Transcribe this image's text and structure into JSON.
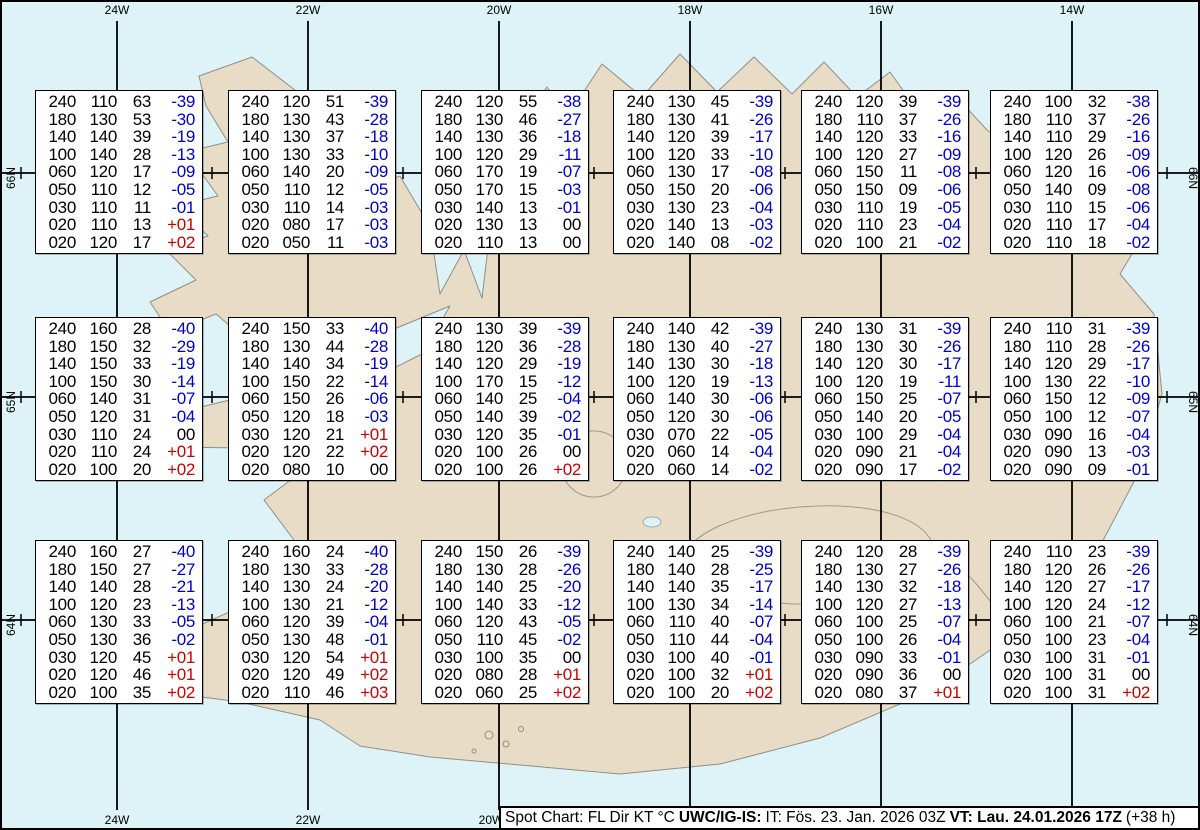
{
  "grid_labels": {
    "top": [
      "24W",
      "22W",
      "20W",
      "18W",
      "16W",
      "14W"
    ],
    "bottom": [
      "24W",
      "22W",
      "20W"
    ],
    "left": [
      "66N",
      "65N",
      "64N"
    ],
    "right": [
      "66N",
      "65N",
      "64N"
    ]
  },
  "status_bar": {
    "chart_label": "Spot Chart: FL Dir KT °C",
    "source": "UWC/IG-IS:",
    "issue_time": "IT: Fös. 23. Jan. 2026 03Z",
    "valid_time": "VT: Lau. 24.01.2026 17Z",
    "lead_time": "(+38 h)"
  },
  "colors": {
    "water": "#ddf3f8",
    "land": "#e9dcc7",
    "coastline": "#8f8f85",
    "temp_negative": "#0000cc",
    "temp_positive": "#cc0000"
  },
  "spot_boxes": [
    {
      "rows": [
        [
          "240",
          "110",
          "63",
          "-39"
        ],
        [
          "180",
          "130",
          "53",
          "-30"
        ],
        [
          "140",
          "140",
          "39",
          "-19"
        ],
        [
          "100",
          "140",
          "28",
          "-13"
        ],
        [
          "060",
          "120",
          "17",
          "-09"
        ],
        [
          "050",
          "110",
          "12",
          "-05"
        ],
        [
          "030",
          "110",
          "11",
          "-01"
        ],
        [
          "020",
          "110",
          "13",
          "+01"
        ],
        [
          "020",
          "120",
          "17",
          "+02"
        ]
      ]
    },
    {
      "rows": [
        [
          "240",
          "120",
          "51",
          "-39"
        ],
        [
          "180",
          "130",
          "43",
          "-28"
        ],
        [
          "140",
          "130",
          "37",
          "-18"
        ],
        [
          "100",
          "130",
          "33",
          "-10"
        ],
        [
          "060",
          "140",
          "20",
          "-09"
        ],
        [
          "050",
          "110",
          "12",
          "-05"
        ],
        [
          "030",
          "110",
          "14",
          "-03"
        ],
        [
          "020",
          "080",
          "17",
          "-03"
        ],
        [
          "020",
          "050",
          "11",
          "-03"
        ]
      ]
    },
    {
      "rows": [
        [
          "240",
          "120",
          "55",
          "-38"
        ],
        [
          "180",
          "130",
          "46",
          "-27"
        ],
        [
          "140",
          "130",
          "36",
          "-18"
        ],
        [
          "100",
          "120",
          "29",
          "-11"
        ],
        [
          "060",
          "170",
          "19",
          "-07"
        ],
        [
          "050",
          "170",
          "15",
          "-03"
        ],
        [
          "030",
          "140",
          "13",
          "-01"
        ],
        [
          "020",
          "130",
          "13",
          "00"
        ],
        [
          "020",
          "110",
          "13",
          "00"
        ]
      ]
    },
    {
      "rows": [
        [
          "240",
          "130",
          "45",
          "-39"
        ],
        [
          "180",
          "130",
          "41",
          "-26"
        ],
        [
          "140",
          "120",
          "39",
          "-17"
        ],
        [
          "100",
          "120",
          "33",
          "-10"
        ],
        [
          "060",
          "130",
          "17",
          "-08"
        ],
        [
          "050",
          "150",
          "20",
          "-06"
        ],
        [
          "030",
          "130",
          "23",
          "-04"
        ],
        [
          "020",
          "140",
          "13",
          "-03"
        ],
        [
          "020",
          "140",
          "08",
          "-02"
        ]
      ]
    },
    {
      "rows": [
        [
          "240",
          "120",
          "39",
          "-39"
        ],
        [
          "180",
          "110",
          "37",
          "-26"
        ],
        [
          "140",
          "120",
          "33",
          "-16"
        ],
        [
          "100",
          "120",
          "27",
          "-09"
        ],
        [
          "060",
          "150",
          "11",
          "-08"
        ],
        [
          "050",
          "150",
          "09",
          "-06"
        ],
        [
          "030",
          "110",
          "19",
          "-05"
        ],
        [
          "020",
          "110",
          "23",
          "-04"
        ],
        [
          "020",
          "100",
          "21",
          "-02"
        ]
      ]
    },
    {
      "rows": [
        [
          "240",
          "100",
          "32",
          "-38"
        ],
        [
          "180",
          "110",
          "37",
          "-26"
        ],
        [
          "140",
          "110",
          "29",
          "-16"
        ],
        [
          "100",
          "120",
          "26",
          "-09"
        ],
        [
          "060",
          "120",
          "16",
          "-06"
        ],
        [
          "050",
          "140",
          "09",
          "-08"
        ],
        [
          "030",
          "110",
          "15",
          "-06"
        ],
        [
          "020",
          "110",
          "17",
          "-04"
        ],
        [
          "020",
          "110",
          "18",
          "-02"
        ]
      ]
    },
    {
      "rows": [
        [
          "240",
          "160",
          "28",
          "-40"
        ],
        [
          "180",
          "150",
          "32",
          "-29"
        ],
        [
          "140",
          "150",
          "33",
          "-19"
        ],
        [
          "100",
          "150",
          "30",
          "-14"
        ],
        [
          "060",
          "140",
          "31",
          "-07"
        ],
        [
          "050",
          "120",
          "31",
          "-04"
        ],
        [
          "030",
          "110",
          "24",
          "00"
        ],
        [
          "020",
          "110",
          "24",
          "+01"
        ],
        [
          "020",
          "100",
          "20",
          "+02"
        ]
      ]
    },
    {
      "rows": [
        [
          "240",
          "150",
          "33",
          "-40"
        ],
        [
          "180",
          "130",
          "44",
          "-28"
        ],
        [
          "140",
          "140",
          "34",
          "-19"
        ],
        [
          "100",
          "150",
          "22",
          "-14"
        ],
        [
          "060",
          "150",
          "26",
          "-06"
        ],
        [
          "050",
          "120",
          "18",
          "-03"
        ],
        [
          "030",
          "120",
          "21",
          "+01"
        ],
        [
          "020",
          "120",
          "22",
          "+02"
        ],
        [
          "020",
          "080",
          "10",
          "00"
        ]
      ]
    },
    {
      "rows": [
        [
          "240",
          "130",
          "39",
          "-39"
        ],
        [
          "180",
          "120",
          "36",
          "-28"
        ],
        [
          "140",
          "120",
          "29",
          "-19"
        ],
        [
          "100",
          "170",
          "15",
          "-12"
        ],
        [
          "060",
          "140",
          "25",
          "-04"
        ],
        [
          "050",
          "140",
          "39",
          "-02"
        ],
        [
          "030",
          "120",
          "35",
          "-01"
        ],
        [
          "020",
          "100",
          "26",
          "00"
        ],
        [
          "020",
          "100",
          "26",
          "+02"
        ]
      ]
    },
    {
      "rows": [
        [
          "240",
          "140",
          "42",
          "-39"
        ],
        [
          "180",
          "130",
          "40",
          "-27"
        ],
        [
          "140",
          "130",
          "30",
          "-18"
        ],
        [
          "100",
          "120",
          "19",
          "-13"
        ],
        [
          "060",
          "140",
          "30",
          "-06"
        ],
        [
          "050",
          "120",
          "30",
          "-06"
        ],
        [
          "030",
          "070",
          "22",
          "-05"
        ],
        [
          "020",
          "060",
          "14",
          "-04"
        ],
        [
          "020",
          "060",
          "14",
          "-02"
        ]
      ]
    },
    {
      "rows": [
        [
          "240",
          "130",
          "31",
          "-39"
        ],
        [
          "180",
          "130",
          "30",
          "-26"
        ],
        [
          "140",
          "120",
          "30",
          "-17"
        ],
        [
          "100",
          "120",
          "19",
          "-11"
        ],
        [
          "060",
          "150",
          "25",
          "-07"
        ],
        [
          "050",
          "140",
          "20",
          "-05"
        ],
        [
          "030",
          "100",
          "29",
          "-04"
        ],
        [
          "020",
          "090",
          "21",
          "-04"
        ],
        [
          "020",
          "090",
          "17",
          "-02"
        ]
      ]
    },
    {
      "rows": [
        [
          "240",
          "110",
          "31",
          "-39"
        ],
        [
          "180",
          "110",
          "28",
          "-26"
        ],
        [
          "140",
          "120",
          "29",
          "-17"
        ],
        [
          "100",
          "130",
          "22",
          "-10"
        ],
        [
          "060",
          "150",
          "12",
          "-09"
        ],
        [
          "050",
          "100",
          "12",
          "-07"
        ],
        [
          "030",
          "090",
          "16",
          "-04"
        ],
        [
          "020",
          "090",
          "13",
          "-03"
        ],
        [
          "020",
          "090",
          "09",
          "-01"
        ]
      ]
    },
    {
      "rows": [
        [
          "240",
          "160",
          "27",
          "-40"
        ],
        [
          "180",
          "150",
          "27",
          "-27"
        ],
        [
          "140",
          "140",
          "28",
          "-21"
        ],
        [
          "100",
          "120",
          "23",
          "-13"
        ],
        [
          "060",
          "130",
          "33",
          "-05"
        ],
        [
          "050",
          "130",
          "36",
          "-02"
        ],
        [
          "030",
          "120",
          "45",
          "+01"
        ],
        [
          "020",
          "120",
          "46",
          "+01"
        ],
        [
          "020",
          "100",
          "35",
          "+02"
        ]
      ]
    },
    {
      "rows": [
        [
          "240",
          "160",
          "24",
          "-40"
        ],
        [
          "180",
          "130",
          "33",
          "-28"
        ],
        [
          "140",
          "130",
          "24",
          "-20"
        ],
        [
          "100",
          "130",
          "21",
          "-12"
        ],
        [
          "060",
          "120",
          "39",
          "-04"
        ],
        [
          "050",
          "130",
          "48",
          "-01"
        ],
        [
          "030",
          "120",
          "54",
          "+01"
        ],
        [
          "020",
          "120",
          "49",
          "+02"
        ],
        [
          "020",
          "110",
          "46",
          "+03"
        ]
      ]
    },
    {
      "rows": [
        [
          "240",
          "150",
          "26",
          "-39"
        ],
        [
          "180",
          "130",
          "28",
          "-26"
        ],
        [
          "140",
          "140",
          "25",
          "-20"
        ],
        [
          "100",
          "140",
          "33",
          "-12"
        ],
        [
          "060",
          "120",
          "43",
          "-05"
        ],
        [
          "050",
          "110",
          "45",
          "-02"
        ],
        [
          "030",
          "100",
          "35",
          "00"
        ],
        [
          "020",
          "080",
          "28",
          "+01"
        ],
        [
          "020",
          "060",
          "25",
          "+02"
        ]
      ]
    },
    {
      "rows": [
        [
          "240",
          "140",
          "25",
          "-39"
        ],
        [
          "180",
          "140",
          "28",
          "-25"
        ],
        [
          "140",
          "140",
          "35",
          "-17"
        ],
        [
          "100",
          "130",
          "34",
          "-14"
        ],
        [
          "060",
          "110",
          "40",
          "-07"
        ],
        [
          "050",
          "110",
          "44",
          "-04"
        ],
        [
          "030",
          "100",
          "40",
          "-01"
        ],
        [
          "020",
          "100",
          "32",
          "+01"
        ],
        [
          "020",
          "100",
          "20",
          "+02"
        ]
      ]
    },
    {
      "rows": [
        [
          "240",
          "120",
          "28",
          "-39"
        ],
        [
          "180",
          "130",
          "27",
          "-26"
        ],
        [
          "140",
          "130",
          "32",
          "-18"
        ],
        [
          "100",
          "120",
          "27",
          "-13"
        ],
        [
          "060",
          "100",
          "25",
          "-07"
        ],
        [
          "050",
          "100",
          "26",
          "-04"
        ],
        [
          "030",
          "090",
          "33",
          "-01"
        ],
        [
          "020",
          "090",
          "36",
          "00"
        ],
        [
          "020",
          "080",
          "37",
          "+01"
        ]
      ]
    },
    {
      "rows": [
        [
          "240",
          "110",
          "23",
          "-39"
        ],
        [
          "180",
          "120",
          "26",
          "-26"
        ],
        [
          "140",
          "120",
          "27",
          "-17"
        ],
        [
          "100",
          "120",
          "24",
          "-12"
        ],
        [
          "060",
          "100",
          "21",
          "-07"
        ],
        [
          "050",
          "100",
          "23",
          "-04"
        ],
        [
          "030",
          "100",
          "31",
          "-01"
        ],
        [
          "020",
          "100",
          "31",
          "00"
        ],
        [
          "020",
          "100",
          "31",
          "+02"
        ]
      ]
    }
  ]
}
